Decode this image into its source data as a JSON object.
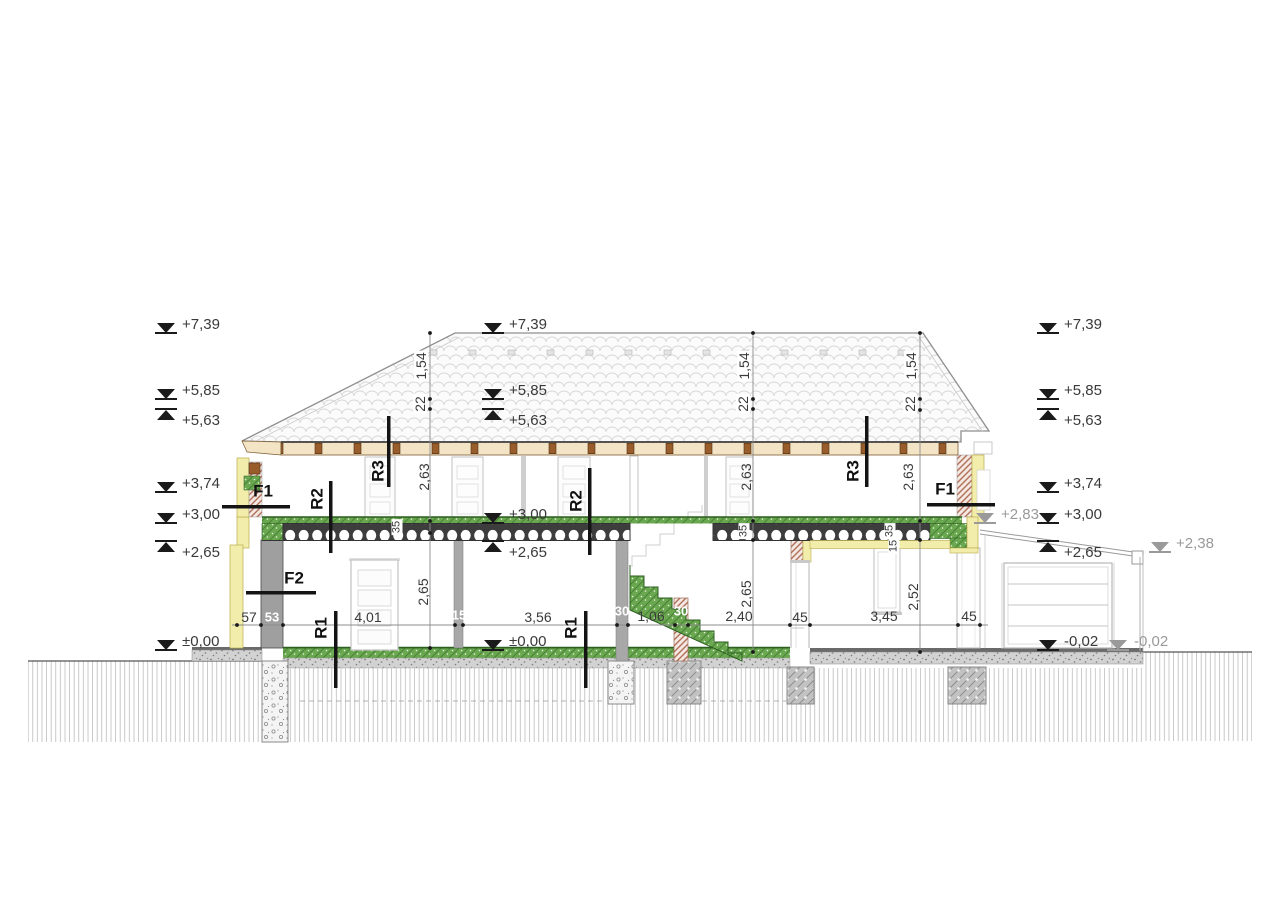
{
  "drawing_type": "building cross-section",
  "dims": {
    "d57": "57",
    "d53": "53",
    "d401": "4,01",
    "d15": "15",
    "d356": "3,56",
    "d30": "30",
    "d106": "1,06",
    "d240": "2,40",
    "d45": "45",
    "d345": "3,45",
    "v154": "1,54",
    "v22": "22",
    "v263": "2,63",
    "v265": "2,65",
    "v252": "2,52",
    "v35": "35"
  },
  "markers": {
    "m739": "+7,39",
    "m585": "+5,85",
    "m563": "+5,63",
    "m374": "+3,74",
    "m300": "+3,00",
    "m265": "+2,65",
    "m000": "±0,00",
    "m002": "-0,02",
    "m283": "+2,83",
    "m238": "+2,38"
  },
  "labels": {
    "f1": "F1",
    "f2": "F2",
    "r1": "R1",
    "r2": "R2",
    "r3": "R3"
  },
  "colors": {
    "insulation_yellow": "#f2edaa",
    "brick_hatch": "#b2705b",
    "concrete_gray": "#9f9f9f",
    "screed_green": "#6aa850",
    "wood_brown": "#995d2b",
    "joist_band_tan": "#f4e4c6",
    "gray_marker": "#9a9a9a",
    "line_dark": "#1a1a1a"
  }
}
